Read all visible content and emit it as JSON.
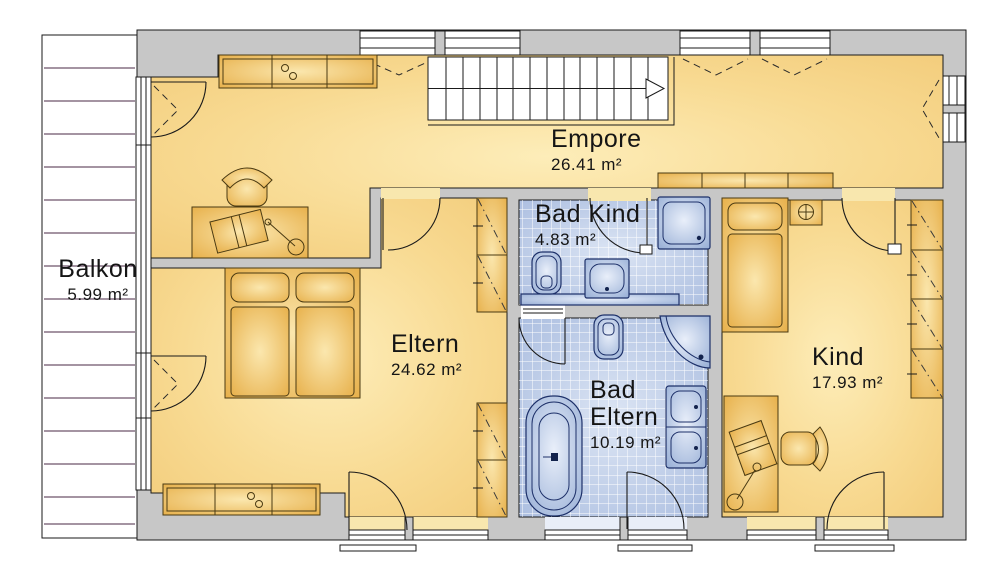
{
  "rooms": {
    "balkon": {
      "name": "Balkon",
      "area": "5.99 m²"
    },
    "empore": {
      "name": "Empore",
      "area": "26.41 m²"
    },
    "bad_kind": {
      "name": "Bad Kind",
      "area": "4.83 m²"
    },
    "eltern": {
      "name": "Eltern",
      "area": "24.62 m²"
    },
    "bad_eltern": {
      "name": "Bad Eltern",
      "area": "10.19 m²"
    },
    "kind": {
      "name": "Kind",
      "area": "17.93 m²"
    }
  },
  "colors": {
    "wall": "#c7c7c7",
    "room_fill": "#f2cb79",
    "room_fill_light": "#fdedb9",
    "tile_fill": "#a9bcdf",
    "fixture_fill": "#8fa8d2",
    "furniture_fill": "#e6ad45",
    "balcony_line": "#4a2a45",
    "outline": "#1a1a1a"
  }
}
